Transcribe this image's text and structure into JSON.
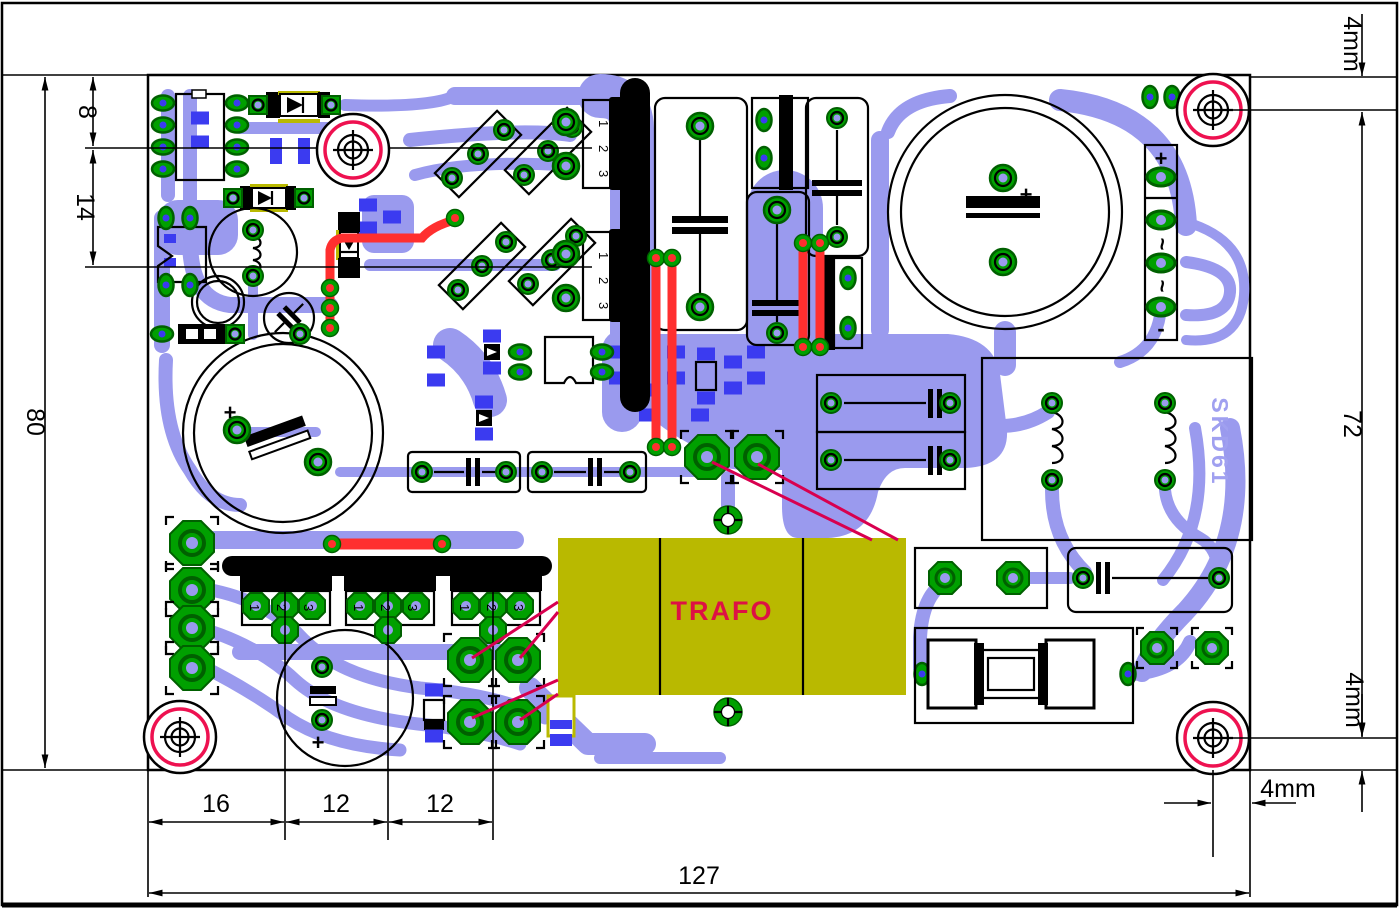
{
  "colors": {
    "trace": "#9a9aee",
    "via_blue": "#3b3bf0",
    "pad_green": "#00a000",
    "pad_green_dark": "#006000",
    "red_trace": "#ff2f2f",
    "red_wire": "#d8004f",
    "hole_ring": "#ee1150",
    "trafo_yellow": "#b9b900",
    "trafo_text_red": "#dd1144",
    "silk_text_blue": "#a0a0f0"
  },
  "dimensions": {
    "overall_height": "80",
    "top_edge_to_hole": "8",
    "hole_to_row": "14",
    "right_top_margin": "4mm",
    "hole_span_height": "72",
    "right_bottom_margin": "4mm",
    "bottom_segments": [
      "16",
      "12",
      "12"
    ],
    "overall_width": "127",
    "corner_margin_horizontal": "4mm"
  },
  "board": {
    "transformer_label": "TRAFO",
    "marking_text": "SKD61",
    "pin_labels": [
      "1",
      "2",
      "3"
    ],
    "connector": {
      "plus": "+",
      "ac_top": "~",
      "ac_bottom": "~",
      "minus": "-"
    },
    "capacitor_polarity": "+"
  }
}
